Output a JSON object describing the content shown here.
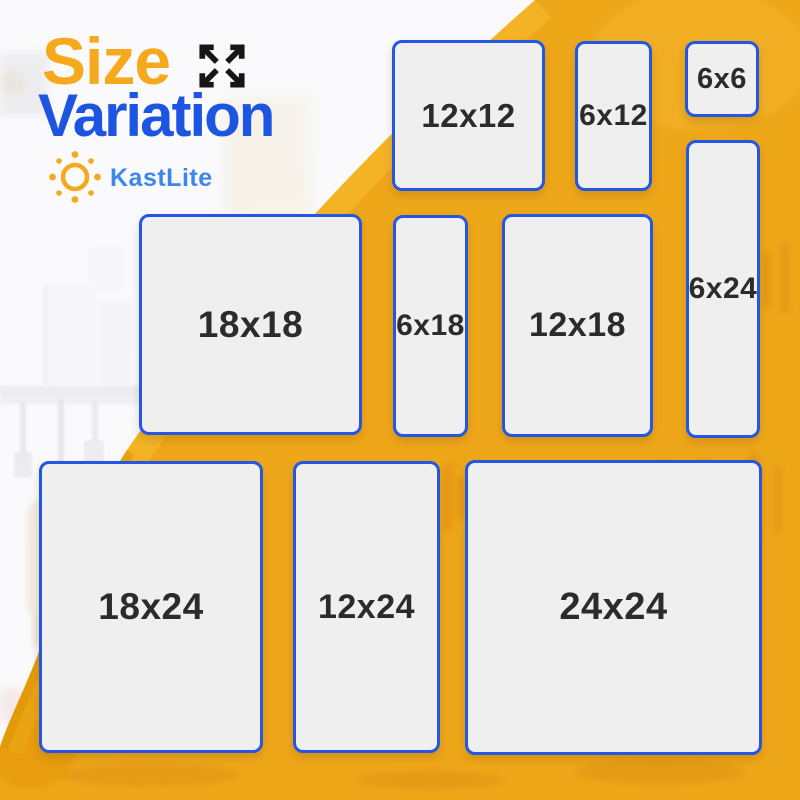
{
  "title": {
    "word1": "Size",
    "word2": "Variation"
  },
  "brand": {
    "name": "KastLite"
  },
  "icons": {
    "expand": "expand-arrows-icon",
    "sun": "sun-logo-icon"
  },
  "colors": {
    "title_orange": "#F6A91D",
    "title_blue": "#1D55E3",
    "brand_blue": "#3C86F0",
    "background_yellow": "#EFA71A",
    "yellow_highlight": "#F9C02E",
    "yellow_shade": "#DF9206",
    "panel_fill": "#EFEFEF",
    "panel_border": "#2257E5",
    "panel_text": "#2B2B2B",
    "icon_black": "#161616"
  },
  "panels": [
    {
      "label": "12x12",
      "x": 392,
      "y": 40,
      "w": 153,
      "h": 151,
      "fs": 33
    },
    {
      "label": "6x12",
      "x": 575,
      "y": 41,
      "w": 77,
      "h": 150,
      "fs": 30
    },
    {
      "label": "6x6",
      "x": 685,
      "y": 41,
      "w": 74,
      "h": 76,
      "fs": 29
    },
    {
      "label": "6x24",
      "x": 686,
      "y": 140,
      "w": 74,
      "h": 298,
      "fs": 30
    },
    {
      "label": "18x18",
      "x": 139,
      "y": 214,
      "w": 223,
      "h": 221,
      "fs": 37
    },
    {
      "label": "6x18",
      "x": 393,
      "y": 215,
      "w": 75,
      "h": 222,
      "fs": 30
    },
    {
      "label": "12x18",
      "x": 502,
      "y": 214,
      "w": 151,
      "h": 223,
      "fs": 34
    },
    {
      "label": "18x24",
      "x": 39,
      "y": 461,
      "w": 224,
      "h": 292,
      "fs": 37
    },
    {
      "label": "12x24",
      "x": 293,
      "y": 461,
      "w": 147,
      "h": 292,
      "fs": 34
    },
    {
      "label": "24x24",
      "x": 465,
      "y": 460,
      "w": 297,
      "h": 295,
      "fs": 38
    }
  ]
}
